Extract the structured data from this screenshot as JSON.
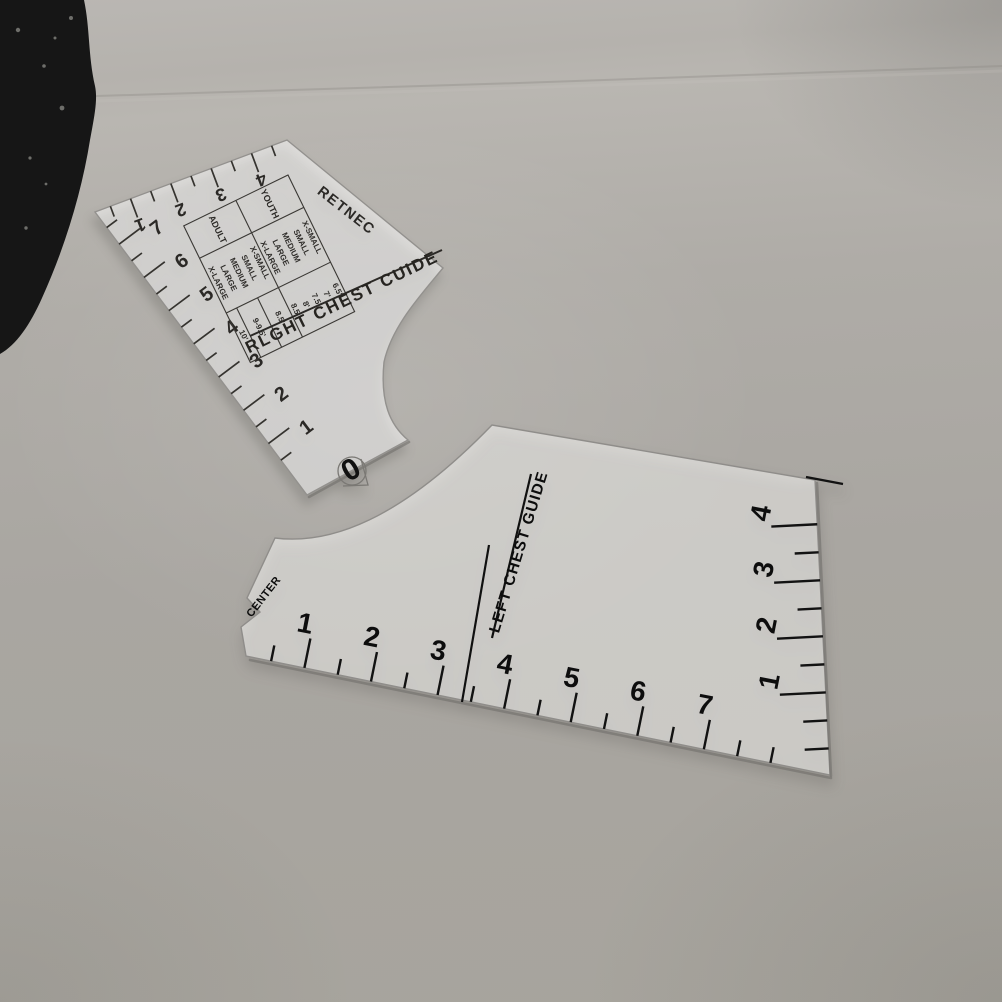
{
  "scene": {
    "backdrop_object": "dark-fabric-corner",
    "colors": {
      "backdrop_top": "#b9b6b2",
      "backdrop_bottom": "#a7a49d",
      "acrylic_tint": "rgba(255,255,255,0.55)",
      "print_soft_black": "#2b2926",
      "print_black": "#0d0d0d"
    }
  },
  "ruler_right_chest": {
    "title": "RLGHT CHEST CUIDE",
    "reversed_center_label": "RETNEC",
    "origin_label": "0",
    "left_edge_scale": {
      "numbers": [
        "7",
        "6",
        "5",
        "4",
        "3",
        "2",
        "1"
      ]
    },
    "top_edge_scale": {
      "numbers": [
        "1",
        "2",
        "3",
        "4"
      ]
    },
    "size_table": {
      "rows": [
        {
          "group": "YOUTH",
          "sizes": [
            "X-SMALL",
            "SMALL",
            "MEDIUM",
            "LARGE",
            "X-LARGE"
          ],
          "values": [
            "6.5'",
            "7'",
            "7.5'",
            "8'",
            "8.5'"
          ]
        },
        {
          "group": "ADULT",
          "sizes": [
            "X-SMALL",
            "SMALL",
            "MEDIUM",
            "LARGE",
            "X-LARGE"
          ],
          "values": [
            "8.5'",
            "9-9.5'",
            "10'"
          ]
        }
      ]
    }
  },
  "ruler_left_chest": {
    "title": "LEFT CHEST GUIDE",
    "notch_label": "CENTER",
    "bottom_edge_scale": {
      "numbers": [
        "1",
        "2",
        "3",
        "4",
        "5",
        "6",
        "7"
      ]
    },
    "right_edge_scale": {
      "numbers": [
        "1",
        "2",
        "3",
        "4"
      ]
    }
  }
}
